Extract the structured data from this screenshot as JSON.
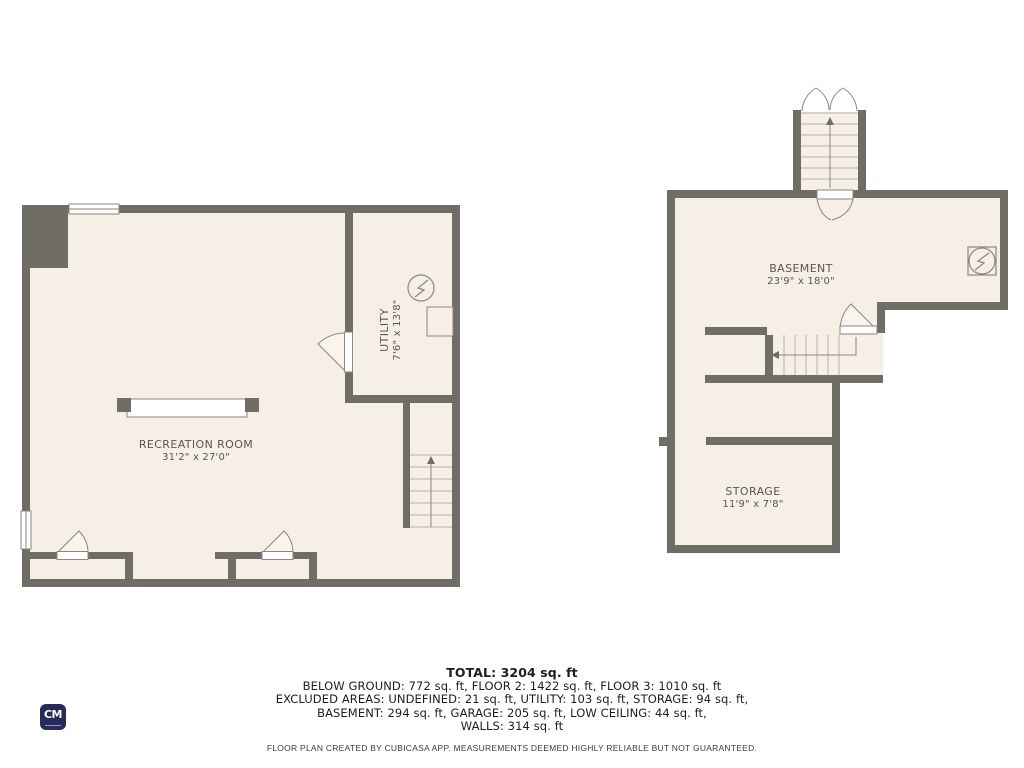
{
  "rooms": {
    "recreation": {
      "name": "RECREATION ROOM",
      "dims": "31'2\" x 27'0\""
    },
    "utility": {
      "name": "UTILITY",
      "dims": "7'6\" x 13'8\""
    },
    "basement": {
      "name": "BASEMENT",
      "dims": "23'9\" x 18'0\""
    },
    "storage": {
      "name": "STORAGE",
      "dims": "11'9\" x 7'8\""
    }
  },
  "summary": {
    "total": "TOTAL: 3204 sq. ft",
    "line1": "BELOW GROUND: 772 sq. ft, FLOOR 2: 1422 sq. ft, FLOOR 3: 1010 sq. ft",
    "line2": "EXCLUDED AREAS: UNDEFINED: 21 sq. ft, UTILITY: 103 sq. ft, STORAGE: 94 sq. ft,",
    "line3": "BASEMENT: 294 sq. ft, GARAGE: 205 sq. ft, LOW CEILING: 44 sq. ft,",
    "line4": "WALLS: 314 sq. ft"
  },
  "disclaimer": "FLOOR PLAN CREATED BY CUBICASA APP. MEASUREMENTS DEEMED HIGHLY RELIABLE BUT NOT GUARANTEED.",
  "logo": {
    "text": "CM"
  },
  "icons": {
    "electric_meter": "circle-with-lightning-bolt",
    "electric_panel": "square-with-lightning-bolt",
    "stairs_up": "arrow-up",
    "stairs_down": "arrow-left"
  },
  "colors": {
    "wall": "#706d67",
    "floor": "#f5efe6",
    "fixture_stroke": "#8b867e",
    "tread_line": "#b7b2a9",
    "background": "#ffffff",
    "logo_bg": "#282a5a"
  }
}
